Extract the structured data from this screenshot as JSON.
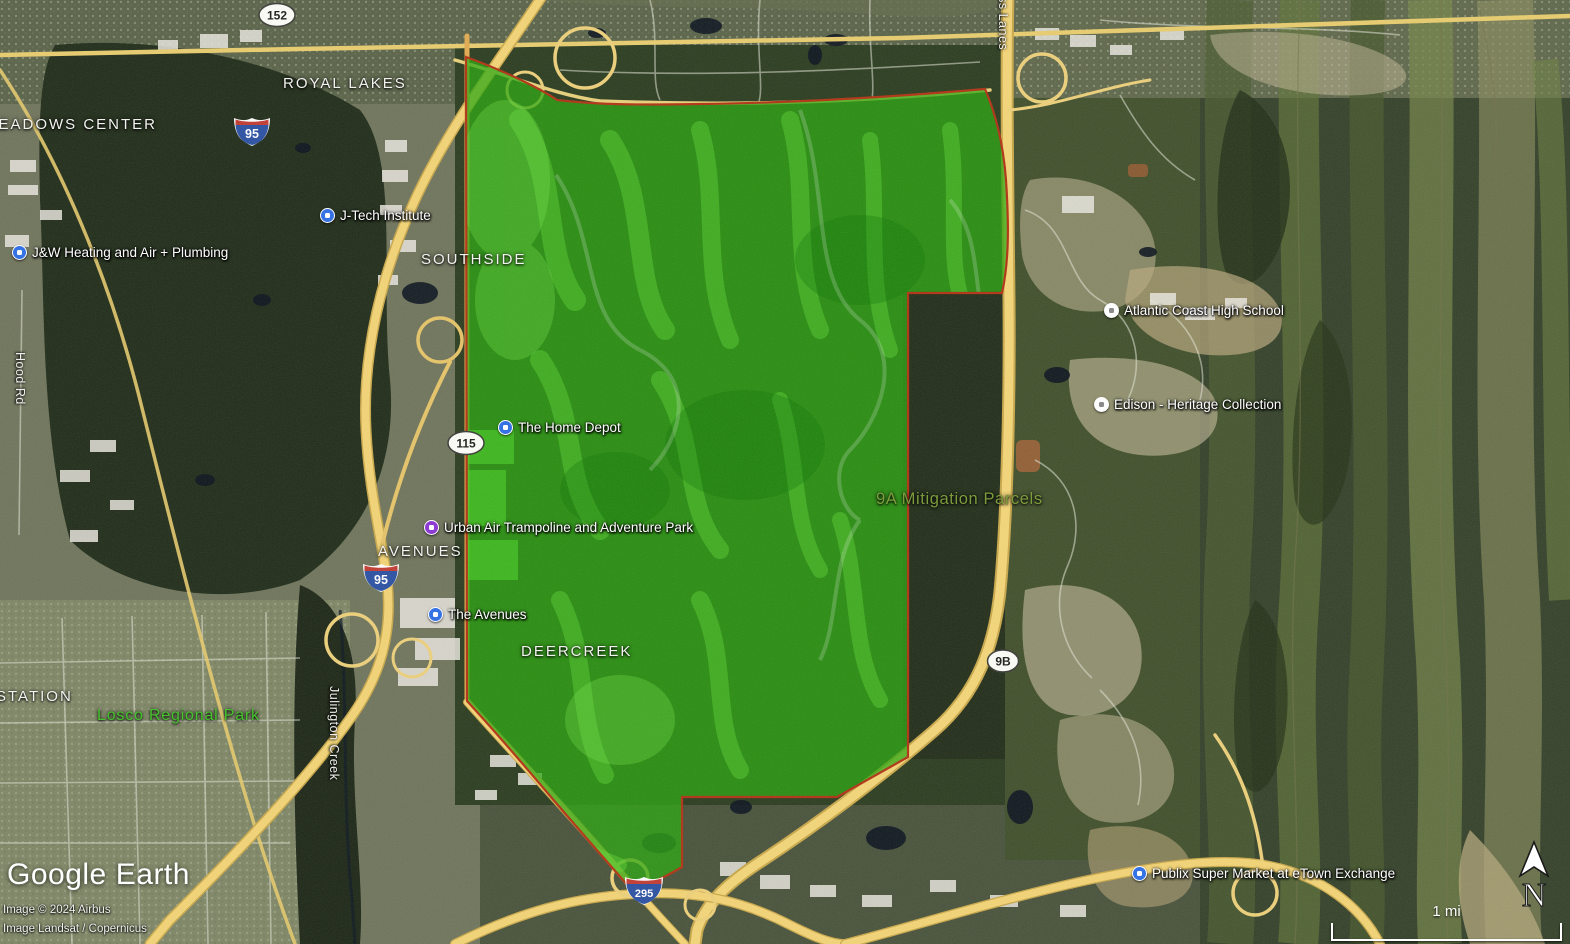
{
  "brand": {
    "logo_word1": "Google",
    "logo_word2": "Earth"
  },
  "attribution": {
    "line1": "Image © 2024 Airbus",
    "line2": "Image Landsat / Copernicus"
  },
  "scale_bar": {
    "distance_label": "1 mi"
  },
  "compass": {
    "north_label": "N"
  },
  "overlay_region": {
    "name": "9A Mitigation Parcels",
    "fill_color": "#2aa80e",
    "border_color": "#b23313"
  },
  "place_labels": {
    "royal_lakes": "ROYAL LAKES",
    "meadows_center": "MEADOWS CENTER",
    "southside": "SOUTHSIDE",
    "avenues": "AVENUES",
    "deercreek": "DEERCREEK",
    "station": "STATION",
    "losco_regional_park": "Losco Regional Park"
  },
  "road_labels": {
    "hood_rd": "Hood Rd",
    "julington_creek": "Julington Creek",
    "express_lanes": "ress Lanes"
  },
  "route_shields": {
    "fl152": "152",
    "i95": "95",
    "fl115": "115",
    "i295": "295",
    "sr9b": "9B"
  },
  "pois": [
    {
      "id": "jw-heating",
      "label": "J&W Heating and Air + Plumbing",
      "marker_color": "#3572e3"
    },
    {
      "id": "jtech-institute",
      "label": "J-Tech Institute",
      "marker_color": "#3572e3"
    },
    {
      "id": "home-depot",
      "label": "The Home Depot",
      "marker_color": "#3572e3"
    },
    {
      "id": "urban-air",
      "label": "Urban Air Trampoline and Adventure Park",
      "marker_color": "#8d3bd3"
    },
    {
      "id": "the-avenues",
      "label": "The Avenues",
      "marker_color": "#3572e3"
    },
    {
      "id": "atlantic-coast-hs",
      "label": "Atlantic Coast High School",
      "marker_color": "#ffffff"
    },
    {
      "id": "edison-heritage",
      "label": "Edison - Heritage Collection",
      "marker_color": "#ffffff"
    },
    {
      "id": "publix-etown",
      "label": "Publix Super Market at eTown Exchange",
      "marker_color": "#3572e3"
    }
  ]
}
